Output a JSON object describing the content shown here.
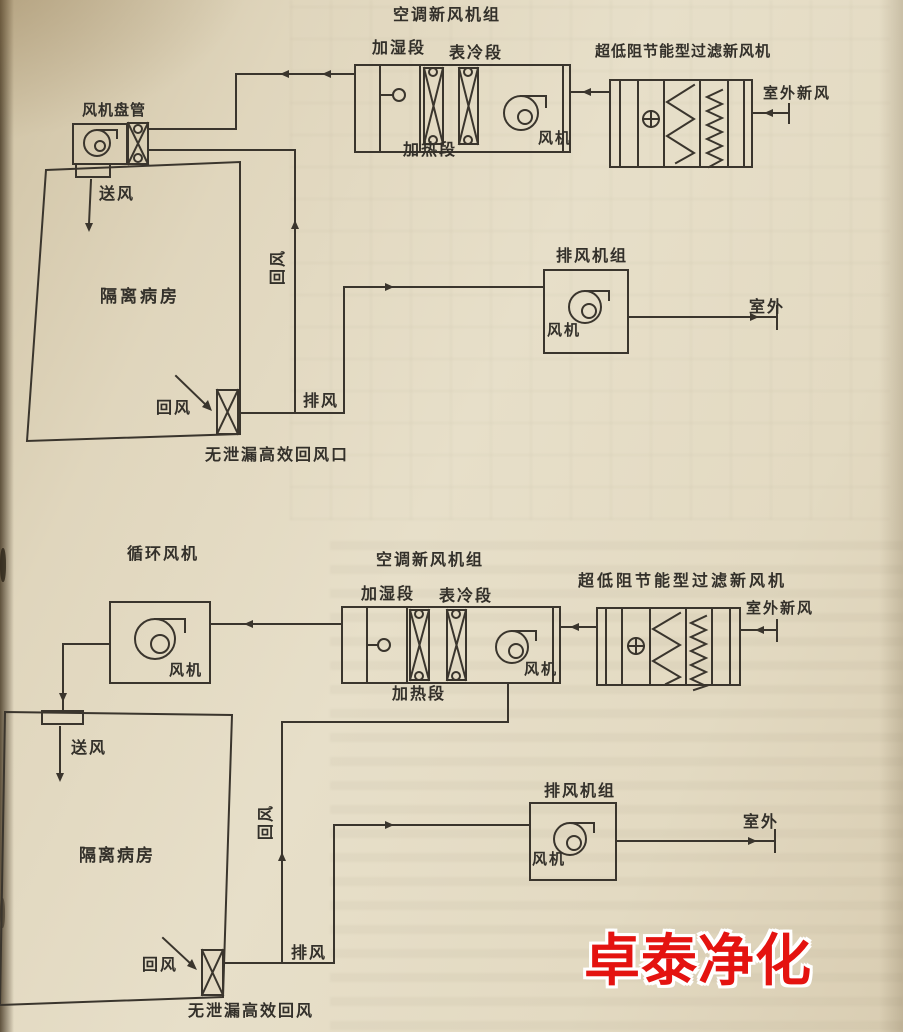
{
  "colors": {
    "page": "#e3d9c2",
    "line": "#3a352d",
    "text": "#33302a",
    "watermark_red": "#e41310"
  },
  "watermark": {
    "text": "卓泰净化"
  },
  "top": {
    "ahu": {
      "title": "空调新风机组",
      "humidify": "加湿段",
      "cooling": "表冷段",
      "heating": "加热段",
      "fan": "风机"
    },
    "filter": {
      "title": "超低阻节能型过滤新风机",
      "outdoor": "室外新风"
    },
    "fancoil": {
      "title": "风机盘管"
    },
    "room": {
      "name": "隔离病房",
      "supply": "送风",
      "return_label": "回风",
      "return_duct": "回风",
      "exhaust_duct": "排风",
      "inlet": "无泄漏高效回风口"
    },
    "exhaust": {
      "title": "排风机组",
      "fan": "风机",
      "outdoor": "室外"
    }
  },
  "bottom": {
    "circfan": {
      "title": "循环风机",
      "fan": "风机"
    },
    "ahu": {
      "title": "空调新风机组",
      "humidify": "加湿段",
      "cooling": "表冷段",
      "heating": "加热段",
      "fan": "风机"
    },
    "filter": {
      "title": "超低阻节能型过滤新风机",
      "outdoor": "室外新风"
    },
    "room": {
      "name": "隔离病房",
      "supply": "送风",
      "return_label": "回风",
      "return_duct": "回风",
      "exhaust_duct": "排风",
      "inlet": "无泄漏高效回风"
    },
    "exhaust": {
      "title": "排风机组",
      "fan": "风机",
      "outdoor": "室外"
    }
  }
}
